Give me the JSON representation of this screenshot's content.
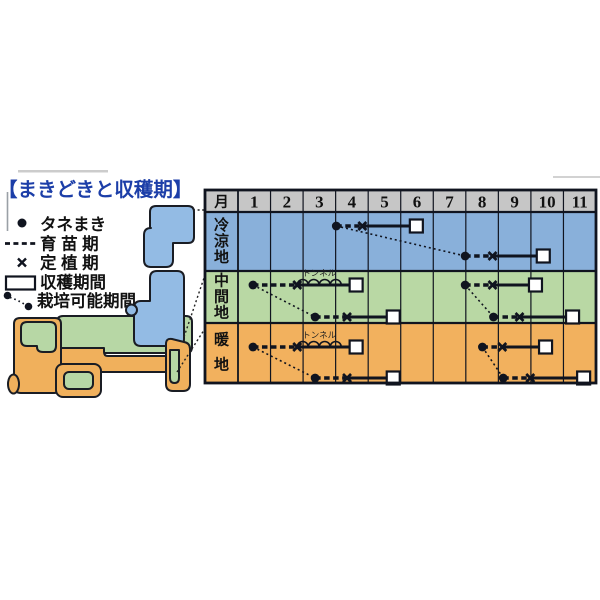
{
  "title": "【まきどきと収穫期】",
  "colors": {
    "cool": "#89b0da",
    "mid": "#b9d8a4",
    "warm": "#f2b15e",
    "map_cool": "#93bbe4",
    "map_mid": "#b7d7a5",
    "map_warm": "#f0b05c",
    "header_gray": "#c6c6c6",
    "line": "#10141f",
    "title_blue": "#1c3ea8",
    "harvest_fill": "#ffffff"
  },
  "legend": {
    "items": [
      {
        "key": "sow-dot",
        "label": "タネまき"
      },
      {
        "key": "seedling-period",
        "label": "育 苗 期"
      },
      {
        "key": "transplant-x",
        "label": "定 植 期"
      },
      {
        "key": "harvest-box",
        "label": "収穫期間"
      },
      {
        "key": "cultivation-range",
        "label": "栽培可能期間"
      }
    ]
  },
  "chart_data": {
    "type": "gantt-calendar",
    "title": "まきどきと収穫期",
    "x_axis": {
      "label": "月",
      "ticks": [
        "1",
        "2",
        "3",
        "4",
        "5",
        "6",
        "7",
        "8",
        "9",
        "10",
        "11"
      ]
    },
    "axis_note": "positions are in month units along the 1-11 axis; 0 = start of month 1",
    "tunnel_label": "トンネル",
    "rows": [
      {
        "region": "冷涼地",
        "color_key": "cool",
        "pairs": [
          {
            "a": {
              "sow": 3.02,
              "plant": 3.82,
              "harvest": 5.48,
              "tunnel": false
            },
            "b": {
              "sow": 6.98,
              "plant": 7.82,
              "harvest": 9.38,
              "tunnel": false
            }
          }
        ]
      },
      {
        "region": "中間地",
        "color_key": "mid",
        "pairs": [
          {
            "a": {
              "sow": 0.46,
              "plant": 1.82,
              "harvest": 3.63,
              "tunnel": true
            },
            "b": {
              "sow": 2.37,
              "plant": 3.35,
              "harvest": 4.77,
              "tunnel": false
            }
          },
          {
            "a": {
              "sow": 6.98,
              "plant": 7.82,
              "harvest": 9.14,
              "tunnel": false
            },
            "b": {
              "sow": 7.85,
              "plant": 8.65,
              "harvest": 10.28,
              "tunnel": false
            }
          }
        ]
      },
      {
        "region": "暖地",
        "color_key": "warm",
        "pairs": [
          {
            "a": {
              "sow": 0.46,
              "plant": 1.82,
              "harvest": 3.63,
              "tunnel": true
            },
            "b": {
              "sow": 2.37,
              "plant": 3.35,
              "harvest": 4.77,
              "tunnel": false
            }
          },
          {
            "a": {
              "sow": 7.51,
              "plant": 8.12,
              "harvest": 9.45,
              "tunnel": false
            },
            "b": {
              "sow": 8.15,
              "plant": 8.98,
              "harvest": 10.62,
              "tunnel": false
            }
          }
        ]
      }
    ]
  }
}
